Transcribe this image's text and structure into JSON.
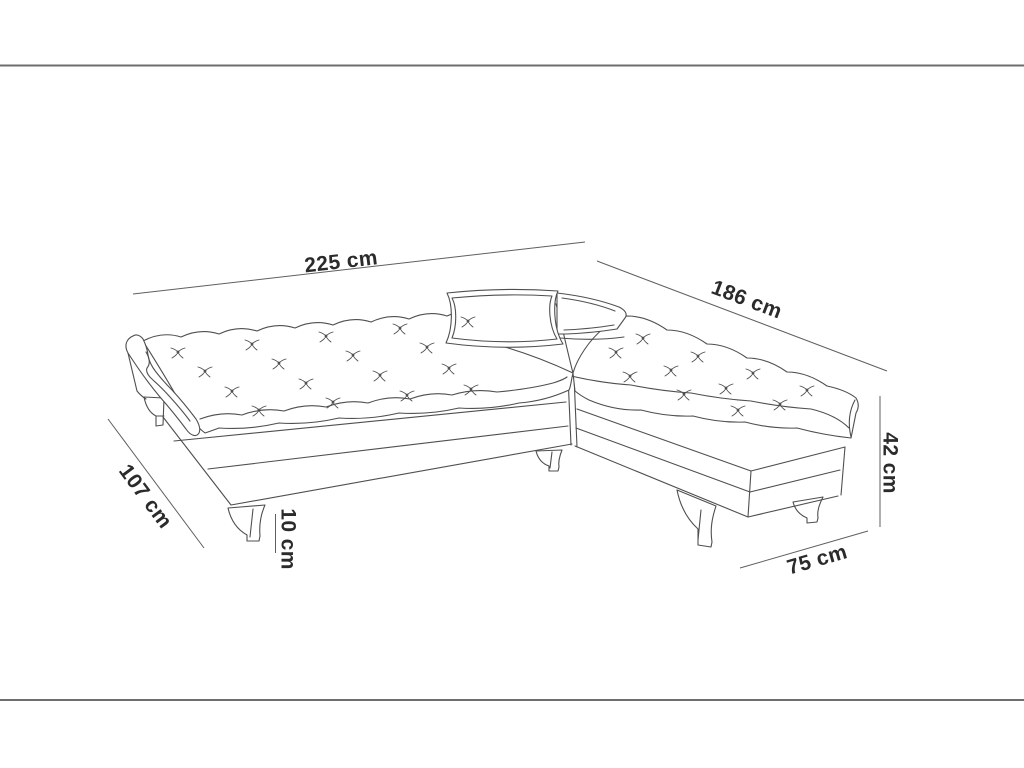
{
  "diagram": {
    "dimensions": [
      {
        "id": "total-width",
        "label": "225 cm"
      },
      {
        "id": "chaise-side-length",
        "label": "186 cm"
      },
      {
        "id": "seat-depth",
        "label": "107 cm"
      },
      {
        "id": "leg-height",
        "label": "10 cm"
      },
      {
        "id": "overall-height",
        "label": "42 cm"
      },
      {
        "id": "chaise-end-width",
        "label": "75 cm"
      }
    ],
    "colors": {
      "background": "#ffffff",
      "artwork_line": "#4f4f4f",
      "dimension_line": "#5f5f5f",
      "label_text": "#2b2b2b",
      "frame_border": "#6e6e6e"
    }
  }
}
